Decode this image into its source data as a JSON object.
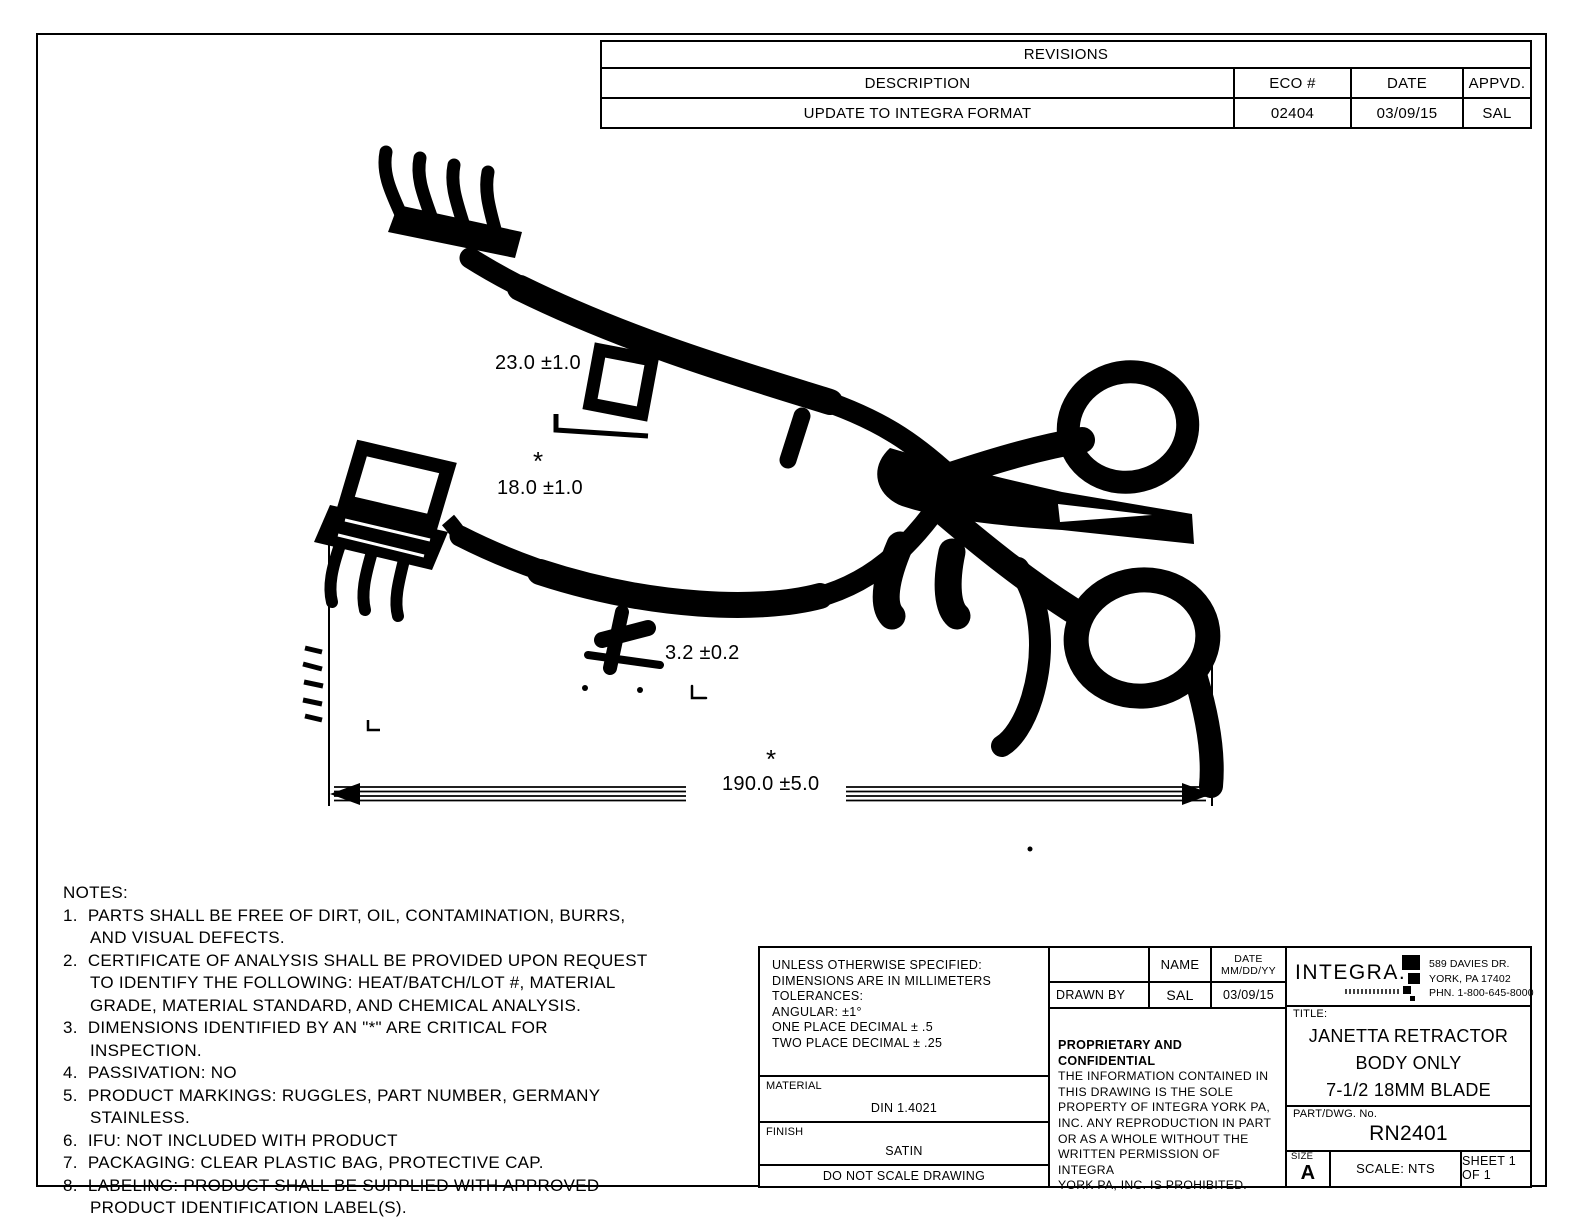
{
  "colors": {
    "ink": "#000000",
    "paper": "#ffffff"
  },
  "revisions": {
    "title": "REVISIONS",
    "col_description": "DESCRIPTION",
    "col_eco": "ECO #",
    "col_date": "DATE",
    "col_appvd": "APPVD.",
    "row": {
      "description": "UPDATE TO INTEGRA FORMAT",
      "eco": "02404",
      "date": "03/09/15",
      "appvd": "SAL"
    }
  },
  "dimensions": {
    "blade_width_upper": "23.0 ±1.0",
    "blade_width_lower": "18.0 ±1.0",
    "prong_thickness": "3.2 ±0.2",
    "overall_length": "190.0 ±5.0",
    "critical_marker": "*"
  },
  "notes": {
    "heading": "NOTES:",
    "items": [
      "1.  PARTS SHALL BE FREE OF DIRT, OIL, CONTAMINATION, BURRS, AND VISUAL DEFECTS.",
      "2.  CERTIFICATE OF ANALYSIS SHALL BE PROVIDED UPON REQUEST TO IDENTIFY THE FOLLOWING: HEAT/BATCH/LOT #, MATERIAL GRADE, MATERIAL STANDARD, AND CHEMICAL ANALYSIS.",
      "3.  DIMENSIONS IDENTIFIED BY AN \"*\" ARE CRITICAL FOR INSPECTION.",
      "4.  PASSIVATION: NO",
      "5.  PRODUCT MARKINGS: RUGGLES, PART NUMBER, GERMANY STAINLESS.",
      "6.  IFU: NOT INCLUDED WITH PRODUCT",
      "7.  PACKAGING: CLEAR PLASTIC BAG, PROTECTIVE CAP.",
      "8.  LABELING: PRODUCT SHALL BE SUPPLIED WITH APPROVED PRODUCT IDENTIFICATION LABEL(S)."
    ]
  },
  "spec": {
    "tolerance_lines": [
      "UNLESS OTHERWISE SPECIFIED:",
      "DIMENSIONS ARE IN MILLIMETERS",
      "TOLERANCES:",
      "ANGULAR: ±1°",
      "ONE PLACE DECIMAL ± .5",
      "TWO PLACE DECIMAL ± .25"
    ],
    "material_label": "MATERIAL",
    "material_value": "DIN 1.4021",
    "finish_label": "FINISH",
    "finish_value": "SATIN",
    "do_not_scale": "DO NOT SCALE DRAWING"
  },
  "approval": {
    "name_header": "NAME",
    "date_header_1": "DATE",
    "date_header_2": "MM/DD/YY",
    "drawn_by_label": "DRAWN BY",
    "drawn_by_name": "SAL",
    "drawn_by_date": "03/09/15",
    "proprietary_heading": "PROPRIETARY AND CONFIDENTIAL",
    "proprietary_lines": [
      "THE INFORMATION CONTAINED IN",
      "THIS DRAWING IS THE SOLE",
      "PROPERTY OF INTEGRA YORK PA,",
      "INC.  ANY REPRODUCTION IN PART",
      "OR AS A WHOLE WITHOUT THE",
      "WRITTEN PERMISSION OF INTEGRA",
      "YORK PA, INC. IS PROHIBITED."
    ]
  },
  "title_block": {
    "logo_text": "INTEGRA.",
    "address_lines": [
      "589 DAVIES DR.",
      "YORK, PA 17402",
      "PHN. 1-800-645-8000"
    ],
    "title_label": "TITLE:",
    "title_lines": [
      "JANETTA RETRACTOR",
      "BODY ONLY",
      "7-1/2 18MM BLADE"
    ],
    "part_label": "PART/DWG. No.",
    "part_number": "RN2401",
    "size_label": "SIZE",
    "size_value": "A",
    "scale": "SCALE: NTS",
    "sheet": "SHEET 1 OF 1"
  }
}
